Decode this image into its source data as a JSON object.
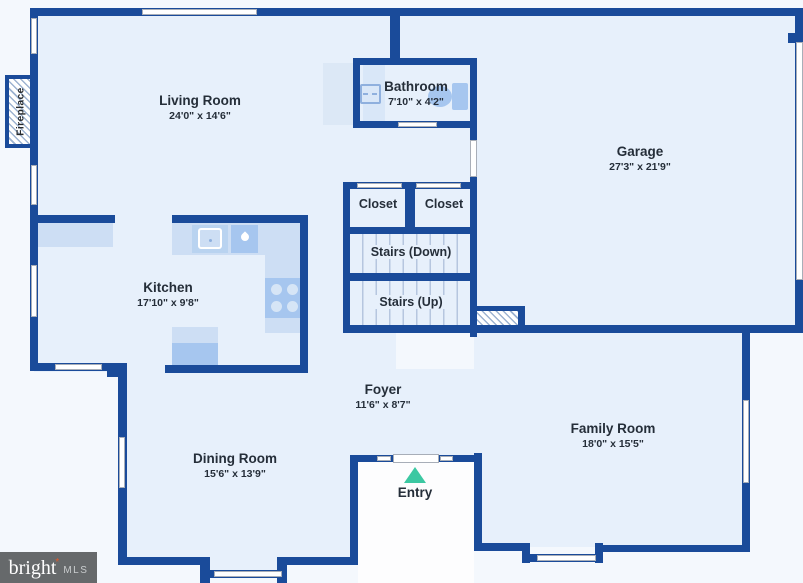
{
  "plan": {
    "rooms": [
      {
        "id": "living-room",
        "name": "Living Room",
        "dims": "24'0\" x 14'6\""
      },
      {
        "id": "bathroom",
        "name": "Bathroom",
        "dims": "7'10\" x 4'2\""
      },
      {
        "id": "garage",
        "name": "Garage",
        "dims": "27'3\" x 21'9\""
      },
      {
        "id": "closet-1",
        "name": "Closet",
        "dims": ""
      },
      {
        "id": "closet-2",
        "name": "Closet",
        "dims": ""
      },
      {
        "id": "stairs-down",
        "name": "Stairs (Down)",
        "dims": ""
      },
      {
        "id": "stairs-up",
        "name": "Stairs (Up)",
        "dims": ""
      },
      {
        "id": "kitchen",
        "name": "Kitchen",
        "dims": "17'10\" x 9'8\""
      },
      {
        "id": "foyer",
        "name": "Foyer",
        "dims": "11'6\" x 8'7\""
      },
      {
        "id": "dining-room",
        "name": "Dining Room",
        "dims": "15'6\" x 13'9\""
      },
      {
        "id": "family-room",
        "name": "Family Room",
        "dims": "18'0\" x 15'5\""
      },
      {
        "id": "entry",
        "name": "Entry",
        "dims": ""
      }
    ],
    "fireplace_label": "Fireplace",
    "colors": {
      "wall": "#1a4b9a",
      "interior": "#e7f0fb",
      "exterior": "#f4f8fd",
      "counter": "#cddef4",
      "appliance": "#a6c6ef",
      "entry_arrow": "#3cc8a2"
    }
  },
  "branding": {
    "brand": "bright",
    "mls": "MLS"
  }
}
